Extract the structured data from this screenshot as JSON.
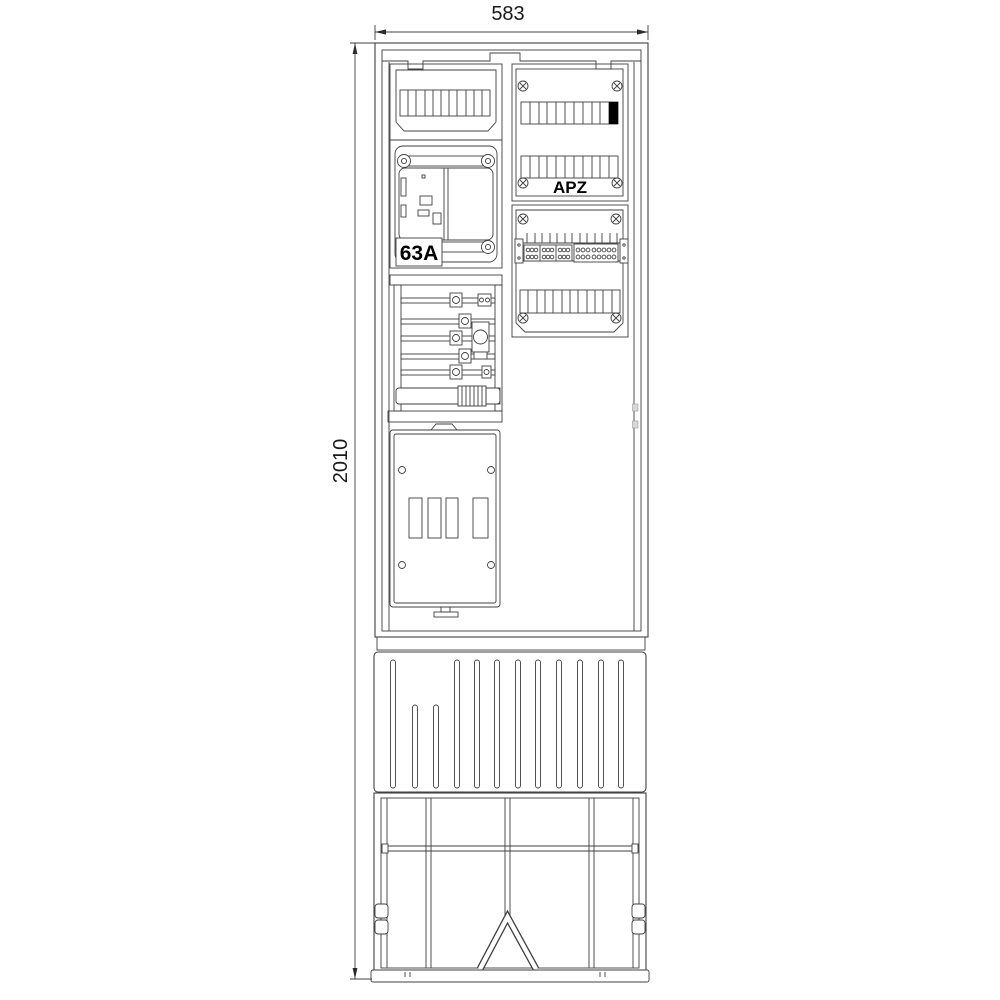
{
  "drawing": {
    "type": "technical drawing - electrical meter connection pillar, front view",
    "dimension_width": "583",
    "dimension_height": "2010",
    "label_apz": "APZ",
    "label_breaker": "63A",
    "colors": {
      "background": "#ffffff",
      "line": "#404040",
      "text": "#1a1a1a",
      "filled_module": "#000000"
    },
    "structure": {
      "top_cover_segments": 11,
      "apz_row1_segments": 11,
      "apz_row1_black_segment": "rightmost",
      "apz_row2_segments": 11,
      "terminal_row_segments": 12,
      "base_ribs": 12,
      "door_slots": 4,
      "meter_rating": "63A"
    }
  }
}
